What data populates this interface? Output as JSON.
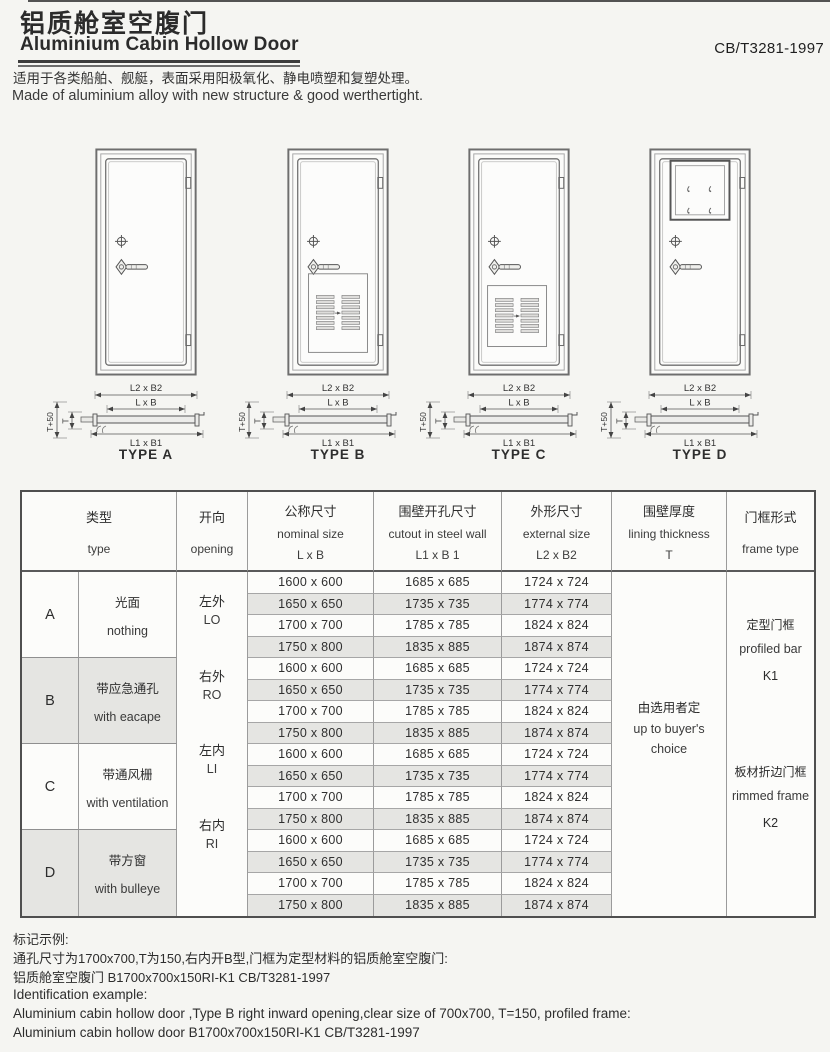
{
  "header": {
    "title_zh": "铝质舱室空腹门",
    "title_en": "Aluminium Cabin Hollow Door",
    "standard": "CB/T3281-1997",
    "desc_zh": "适用于各类船舶、舰艇，表面采用阳极氧化、静电喷塑和复塑处理。",
    "desc_en": "Made of aluminium alloy with new structure & good werthertight."
  },
  "doors": [
    {
      "code": "A",
      "label": "TYPE A",
      "feature": "plain"
    },
    {
      "code": "B",
      "label": "TYPE B",
      "feature": "louver-large"
    },
    {
      "code": "C",
      "label": "TYPE C",
      "feature": "louver-small"
    },
    {
      "code": "D",
      "label": "TYPE D",
      "feature": "window"
    }
  ],
  "section_labels": {
    "outer": "L2 x B2",
    "clear": "L x B",
    "cutout": "L1 x B1",
    "t50": "T+50",
    "t": "T"
  },
  "table": {
    "headers": {
      "type": {
        "zh": "类型",
        "en": "type"
      },
      "opening": {
        "zh": "开向",
        "en": "opening"
      },
      "nominal": {
        "zh": "公称尺寸",
        "en": "nominal size",
        "sub": "L x B"
      },
      "cutout": {
        "zh": "围壁开孔尺寸",
        "en": "cutout in steel wall",
        "sub": "L1 x B 1"
      },
      "external": {
        "zh": "外形尺寸",
        "en": "external  size",
        "sub": "L2 x B2"
      },
      "lining": {
        "zh": "围壁厚度",
        "en": "lining thickness",
        "sub": "T"
      },
      "frame": {
        "zh": "门框形式",
        "en": "frame type"
      }
    },
    "groups": [
      {
        "letter": "A",
        "desc_zh": "光面",
        "desc_en": "nothing",
        "shaded": false
      },
      {
        "letter": "B",
        "desc_zh": "带应急通孔",
        "desc_en": "with eacape",
        "shaded": true
      },
      {
        "letter": "C",
        "desc_zh": "带通风栅",
        "desc_en": "with ventilation",
        "shaded": false
      },
      {
        "letter": "D",
        "desc_zh": "带方窗",
        "desc_en": "with bulleye",
        "shaded": true
      }
    ],
    "openings": [
      {
        "zh": "左外",
        "en": "LO"
      },
      {
        "zh": "右外",
        "en": "RO"
      },
      {
        "zh": "左内",
        "en": "LI"
      },
      {
        "zh": "右内",
        "en": "RI"
      }
    ],
    "size_rows": [
      {
        "nominal": "1600 x 600",
        "cutout": "1685 x 685",
        "external": "1724 x 724"
      },
      {
        "nominal": "1650 x 650",
        "cutout": "1735 x 735",
        "external": "1774 x 774"
      },
      {
        "nominal": "1700 x 700",
        "cutout": "1785 x 785",
        "external": "1824 x 824"
      },
      {
        "nominal": "1750 x 800",
        "cutout": "1835 x 885",
        "external": "1874 x 874"
      }
    ],
    "lining": {
      "zh": "由选用者定",
      "en1": "up to buyer's",
      "en2": "choice"
    },
    "frames": [
      {
        "zh": "定型门框",
        "en": "profiled bar",
        "code": "K1"
      },
      {
        "zh": "板材折边门框",
        "en": "rimmed frame",
        "code": "K2"
      }
    ]
  },
  "notes": {
    "zh_title": "标记示例:",
    "zh_line1": "通孔尺寸为1700x700,T为150,右内开B型,门框为定型材料的铝质舱室空腹门:",
    "zh_line2": "铝质舱室空腹门 B1700x700x150RI-K1 CB/T3281-1997",
    "en_title": "Identification example:",
    "en_line1": "Aluminium cabin hollow door ,Type B right inward opening,clear size of 700x700, T=150, profiled frame:",
    "en_line2": "Aluminium cabin hollow door B1700x700x150RI-K1 CB/T3281-1997"
  },
  "colors": {
    "shade": "#e5e5e2",
    "ink": "#2b2b2b",
    "table_border": "#4f4f4f"
  }
}
